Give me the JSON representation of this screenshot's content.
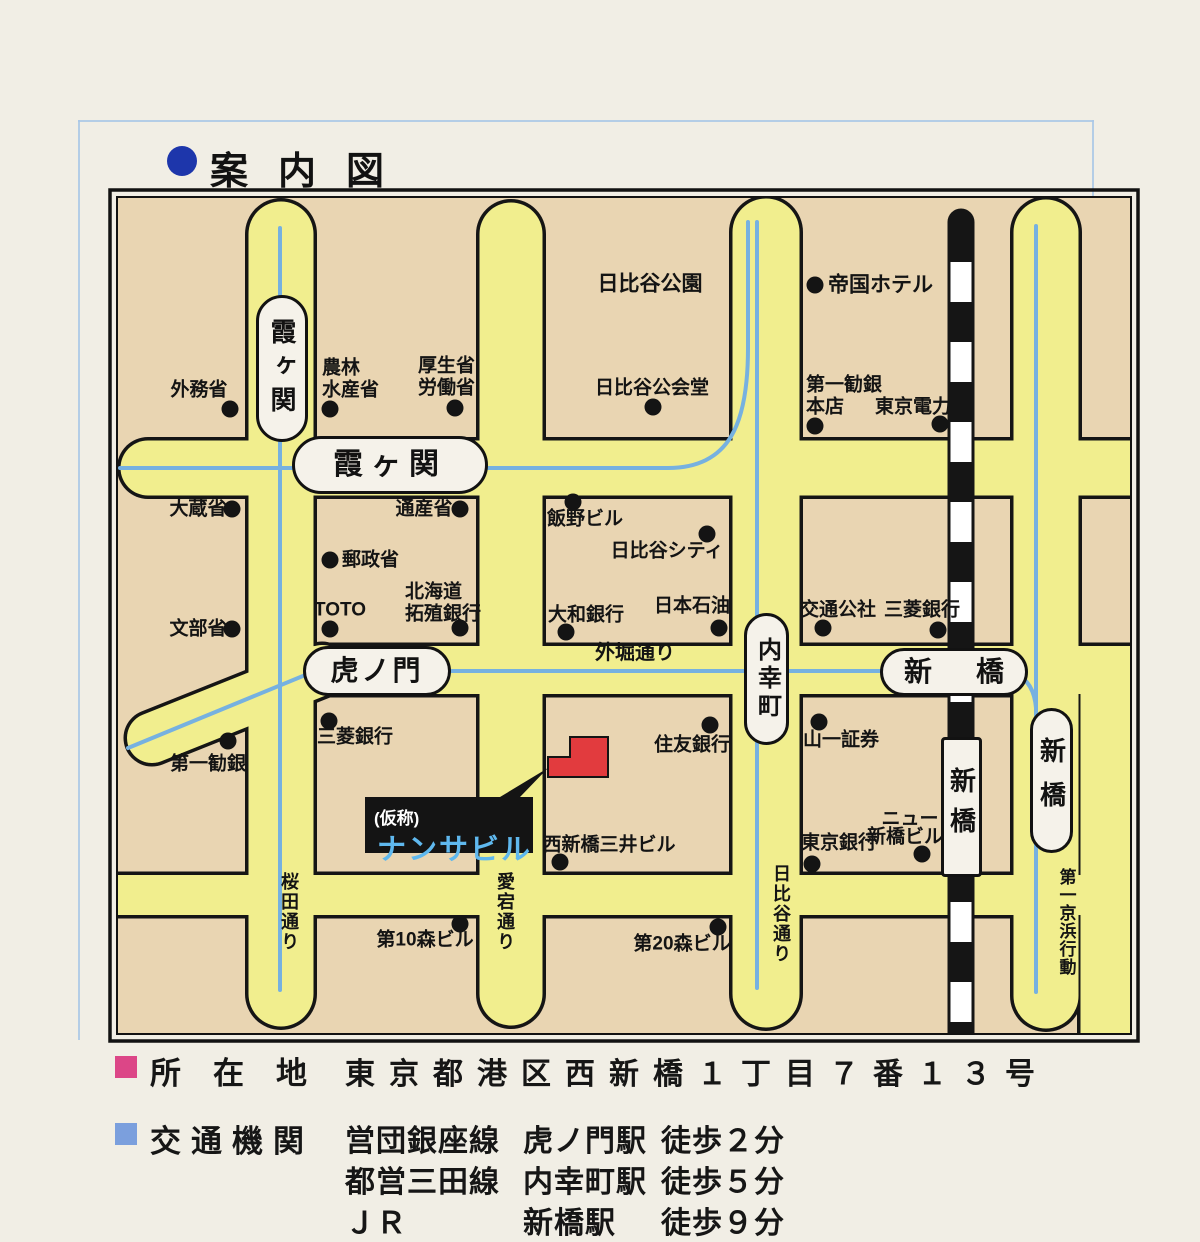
{
  "title": "案内図",
  "colors": {
    "road_yellow": "#f1ee8e",
    "block_cream": "#e9d5b2",
    "rail_blue": "#76b1e0",
    "landmark_red": "#e23b3e",
    "landmark_name_blue": "#5fb8ee",
    "address_bullet": "#dc4687",
    "access_bullet": "#7b9fdd",
    "title_bullet": "#1d36ab"
  },
  "map": {
    "landmark": {
      "note": "(仮称)",
      "name": "ナンサビル"
    },
    "labels": {
      "kasumigaseki_v": "霞ヶ関",
      "kasumigaseki_h": "霞ヶ関",
      "toranomon": "虎ノ門",
      "uchisaiwaicho": "内幸町",
      "shimbashi_h": "新橋",
      "shimbashi_jr": "新橋",
      "shimbashi_r": "新橋",
      "gaimusho": "外務省",
      "norin1": "農林",
      "norin2": "水産省",
      "kosei1": "厚生省",
      "kosei2": "労働省",
      "hibiya_park": "日比谷公園",
      "hibiya_hall": "日比谷公会堂",
      "teikoku_hotel": "帝国ホテル",
      "daiichi_honten1": "第一勧銀",
      "daiichi_honten2": "本店",
      "tokyo_denryoku": "東京電力",
      "okurasho": "大蔵省",
      "tsusansho": "通産省",
      "yuseisho": "郵政省",
      "toto": "TOTO",
      "hokkaido1": "北海道",
      "hokkaido2": "拓殖銀行",
      "mombusho": "文部省",
      "iino_bldg": "飯野ビル",
      "hibiya_city": "日比谷シティ",
      "daiwa_bank": "大和銀行",
      "nihon_sekiyu": "日本石油",
      "sotobori_dori": "外堀通り",
      "kotsu_kosha": "交通公社",
      "mitsubishi_bank_e": "三菱銀行",
      "daiichi_kangin": "第一勧銀",
      "mitsubishi_bank_w": "三菱銀行",
      "sumitomo_bank": "住友銀行",
      "nishishimbashi_mitsui": "西新橋三井ビル",
      "yamaichi": "山一証券",
      "new_shimbashi1": "ニュー",
      "new_shimbashi2": "新橋ビル",
      "tokyo_bank": "東京銀行",
      "mori10": "第10森ビル",
      "mori20": "第20森ビル",
      "sakurada_dori": "桜田通り",
      "atago_dori": "愛宕通り",
      "hibiya_dori": "日比谷通り",
      "keihin": "第一京浜行動"
    }
  },
  "legend": {
    "address": {
      "label": "所在地",
      "value": "東京都港区西新橋１丁目７番１３号"
    },
    "access": {
      "label": "交通機関",
      "routes": [
        {
          "line": "営団銀座線",
          "station": "虎ノ門駅",
          "walk": "徒歩２分"
        },
        {
          "line": "都営三田線",
          "station": "内幸町駅",
          "walk": "徒歩５分"
        },
        {
          "line": "ＪＲ",
          "station": "新橋駅",
          "walk": "徒歩９分"
        }
      ]
    }
  }
}
